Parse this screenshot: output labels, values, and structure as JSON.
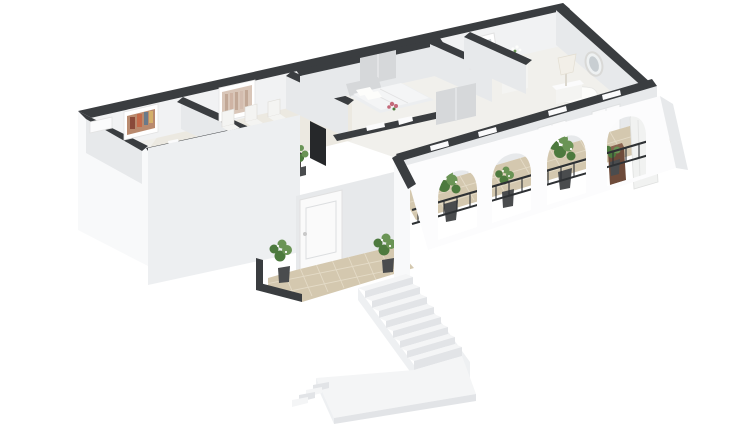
{
  "meta": {
    "description": "Isometric 3D floor plan rendering of an apartment: dark-topped white walls, furnished dining room with table and six chairs, bedroom with bed and pink flowers, dressing room with mirror and dresser, bedroom with lamp and oval wall frame, arched balcony with black railings and potted plants, recessed entry porch with white door and two plants on tan tile, and a white exterior staircase with landing descending from the porch.",
    "background": "#ffffff"
  },
  "colors": {
    "background": "#ffffff",
    "wall_top": "#3a3d40",
    "wall_inner": "#f1f2f3",
    "wall_inner_shade": "#e7e9eb",
    "wall_ext_light": "#f8f9fa",
    "wall_ext_shade": "#edeff1",
    "floor": "#f1f0ec",
    "floor_dining": "#ece9e1",
    "tile": "#d4c8af",
    "tile_grout": "#e4dbc7",
    "stair_top": "#f4f5f6",
    "stair_riser": "#e2e4e7",
    "stair_side": "#eef0f2",
    "railing": "#2e3134",
    "plant": "#4d7a3e",
    "plant_light": "#6a9455",
    "pot": "#4a4c4e",
    "table": "#453e39",
    "table_dark": "#332e2a",
    "tv": "#26282a",
    "art": "#d9c6b8",
    "art_frame": "#ffffff",
    "flower_pink": "#c4697a",
    "flower_white": "#fdfdfb",
    "box_brown": "#6e4b3a",
    "box_brown_light": "#8a6450",
    "appliance": "#f1f2f1",
    "furniture_white": "#f4f4f2",
    "furniture_gray": "#d6d8da",
    "bed_light": "#eceef0",
    "window_white": "#fbfbfc",
    "door_white": "#fafafa"
  },
  "scene": {
    "objects": [
      {
        "name": "entry-room-picture"
      },
      {
        "name": "dining-wall-art"
      },
      {
        "name": "dining-table-set"
      },
      {
        "name": "wall-tv"
      },
      {
        "name": "corner-plant"
      },
      {
        "name": "bed-with-flowers"
      },
      {
        "name": "wardrobe"
      },
      {
        "name": "leaning-mirror"
      },
      {
        "name": "dresser-with-vase"
      },
      {
        "name": "table-lamp"
      },
      {
        "name": "oval-wall-frame"
      },
      {
        "name": "balcony-arches"
      },
      {
        "name": "balcony-railings"
      },
      {
        "name": "balcony-plants"
      },
      {
        "name": "water-heater"
      },
      {
        "name": "wooden-box"
      },
      {
        "name": "entry-door"
      },
      {
        "name": "porch-plants"
      },
      {
        "name": "exterior-staircase"
      }
    ]
  }
}
